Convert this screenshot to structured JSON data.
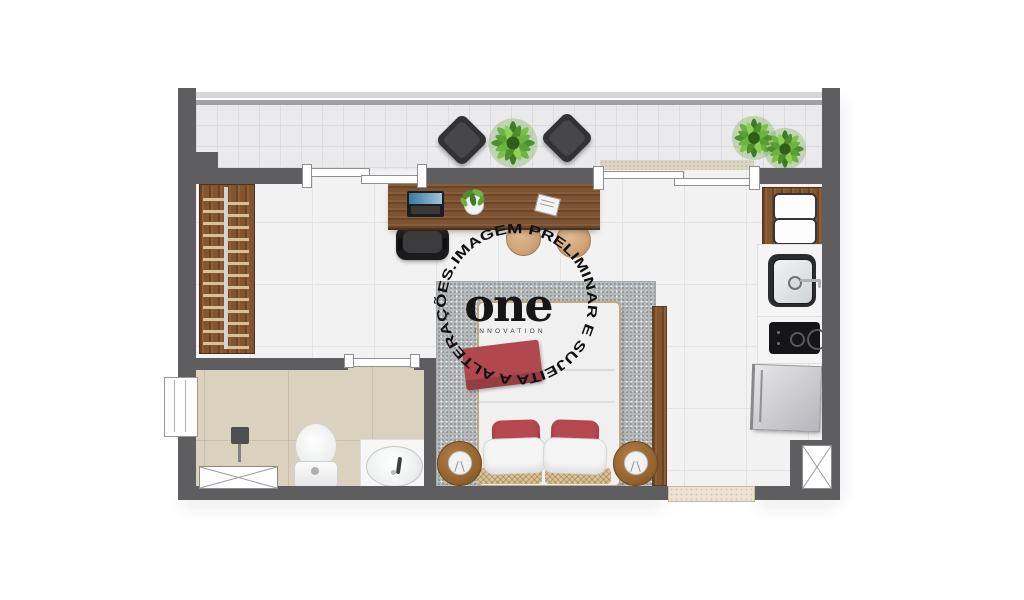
{
  "watermark": {
    "ring_text": "IMAGEM PRELIMINAR E SUJEITA A ALTERAÇÕES. ",
    "brand": "one",
    "brand_sub": "INNOVATION"
  },
  "palette": {
    "wall": "#5e5e60",
    "interior_floor": "#f2f2f3",
    "balcony_floor": "#eaeaec",
    "bathroom_floor": "#dbd1bf",
    "wood": "#82552e",
    "rug": "#b5b8b9",
    "accent_red": "#b2484f",
    "plant_green": "#6cb33f",
    "appliance_dark": "#18181a",
    "fridge_silver": "#c9c9cc"
  },
  "floorplan": {
    "type": "studio-apartment-top-view",
    "areas": [
      "balcony",
      "living-sleeping-area",
      "kitchen-strip",
      "bathroom",
      "wardrobe-nook"
    ],
    "furniture": [
      "balcony-armchair-left",
      "balcony-armchair-right",
      "balcony-plant-center",
      "balcony-plant-right-1",
      "balcony-plant-right-2",
      "work-desk",
      "laptop",
      "desk-plant",
      "notebook",
      "office-chair",
      "stool-1",
      "stool-2",
      "wall-shelf",
      "wardrobe-with-hangers",
      "double-bed",
      "red-throw",
      "red-pillows",
      "white-pillows",
      "rattan-bench",
      "nightstand-left",
      "nightstand-right",
      "bedside-lamp-left",
      "bedside-lamp-right",
      "area-rug",
      "wood-side-panel",
      "shower-head",
      "shower-drain-box",
      "toilet",
      "bathroom-sink",
      "kitchen-tall-cabinet",
      "kitchen-sink",
      "cooktop",
      "refrigerator",
      "entry-threshold",
      "service-shaft"
    ]
  }
}
